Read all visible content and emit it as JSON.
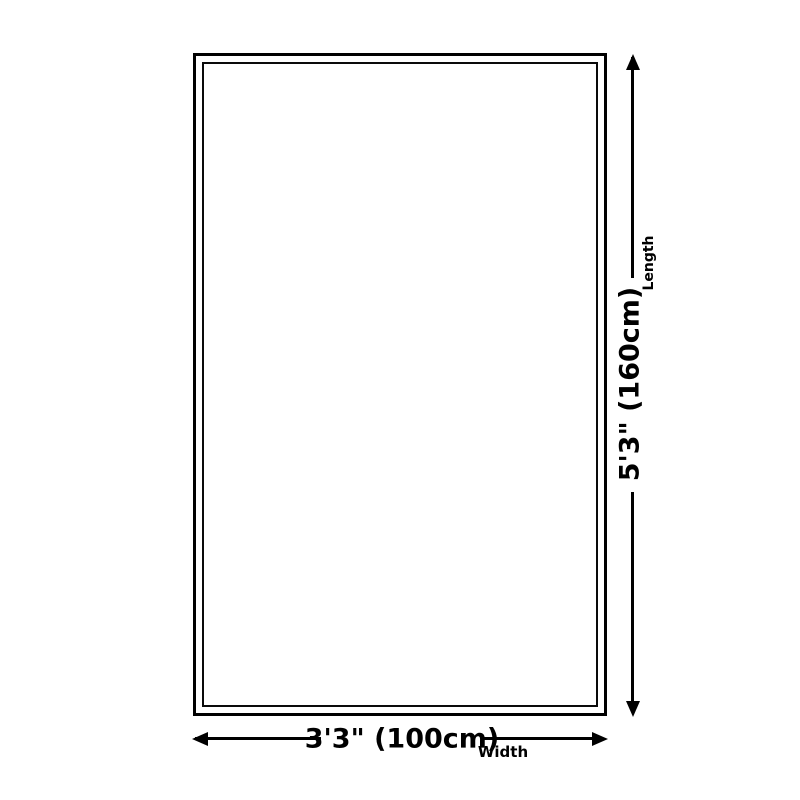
{
  "diagram": {
    "type": "product-dimension-diagram",
    "background_color": "#ffffff",
    "line_color": "#000000",
    "length": {
      "value": "5'3\" (160cm)",
      "label": "Length"
    },
    "width": {
      "value": "3'3\" (100cm)",
      "label": "Width"
    }
  }
}
